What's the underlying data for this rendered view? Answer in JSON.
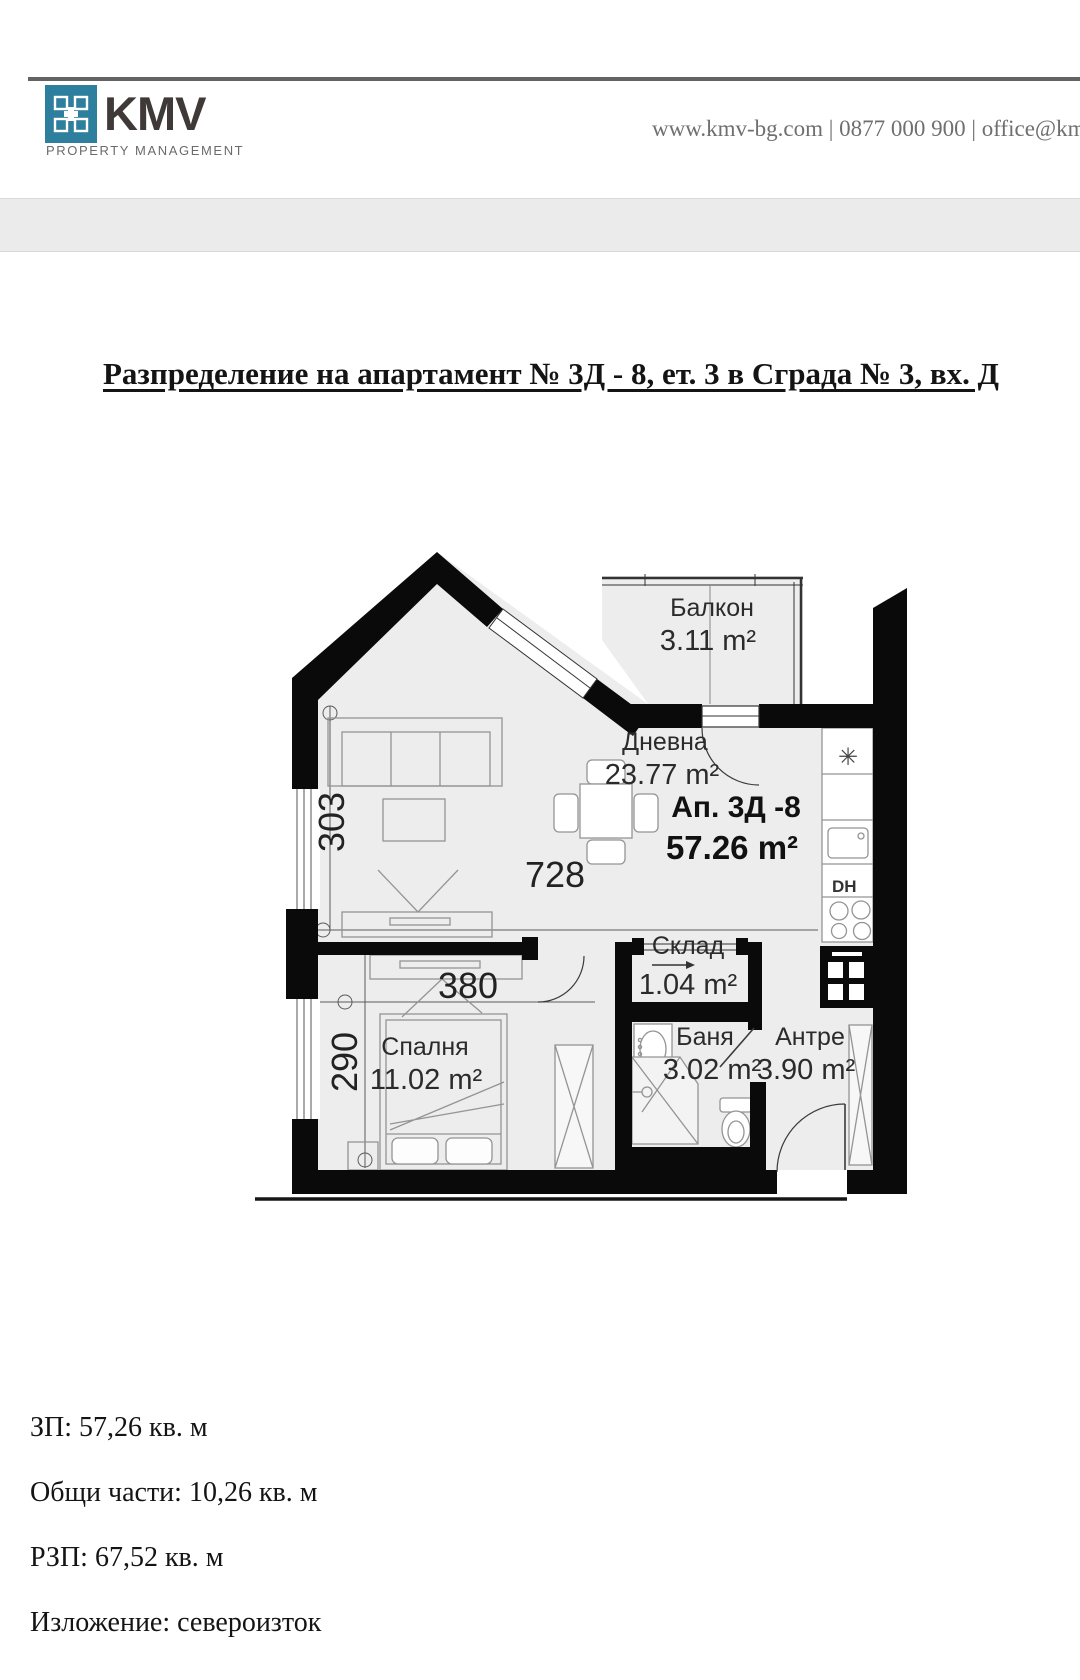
{
  "header": {
    "brand": "KMV",
    "tagline": "PROPERTY MANAGEMENT",
    "contact": "www.kmv-bg.com | 0877 000 900 | office@kmv-",
    "logo_color": "#2e7e9e"
  },
  "title": "Разпределение на апартамент № 3Д - 8, ет. 3 в Сграда № 3, вх. Д",
  "floorplan": {
    "unit_label": "Ап. 3Д -8",
    "unit_area": "57.26 m²",
    "rooms": [
      {
        "name": "Балкон",
        "area": "3.11 m²"
      },
      {
        "name": "Дневна",
        "area": "23.77 m²"
      },
      {
        "name": "Склад",
        "area": "1.04 m²"
      },
      {
        "name": "Баня",
        "area": "3.02 m²"
      },
      {
        "name": "Антре",
        "area": "3.90 m²"
      },
      {
        "name": "Спалня",
        "area": "11.02 m²"
      }
    ],
    "dimensions": {
      "living_width": "728",
      "living_height": "303",
      "bedroom_width": "380",
      "bedroom_height": "290"
    },
    "kitchen": {
      "vent": "✳",
      "dishwasher": "DH"
    }
  },
  "summary": {
    "zp": "ЗП: 57,26 кв. м",
    "common": "Общи части: 10,26 кв. м",
    "rzp": "РЗП: 67,52 кв. м",
    "exposure": "Изложение: североизток"
  },
  "colors": {
    "accent": "#2e7e9e",
    "band": "#ebebeb",
    "wall": "#000000",
    "floor": "#ededed"
  }
}
